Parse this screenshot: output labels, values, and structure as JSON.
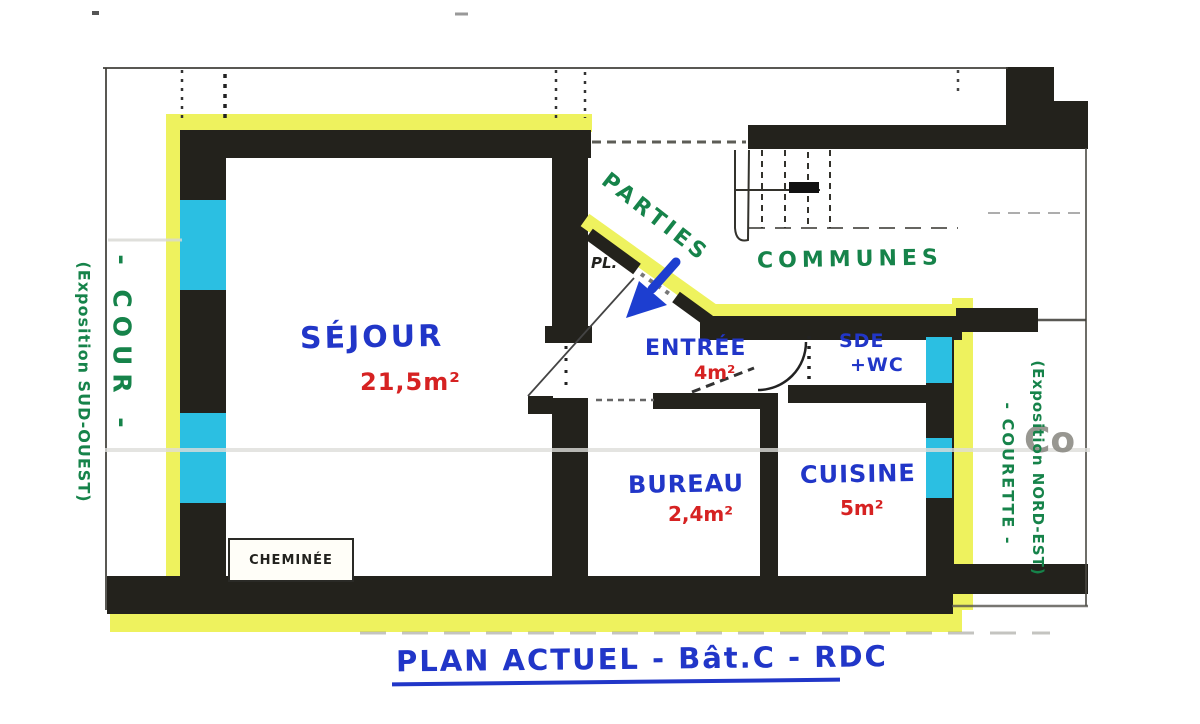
{
  "document": {
    "title": "PLAN ACTUEL - Bât.C - RDC"
  },
  "rooms": {
    "sejour": {
      "name": "SÉJOUR",
      "area": "21,5m²"
    },
    "entree": {
      "name": "ENTRÉE",
      "area": "4m²"
    },
    "bureau": {
      "name": "BUREAU",
      "area": "2,4m²"
    },
    "cuisine": {
      "name": "CUISINE",
      "area": "5m²"
    },
    "sde": {
      "name": "SDE",
      "name2": "+WC"
    }
  },
  "common_areas": {
    "word1": "PARTIES",
    "word2": "COMMUNES"
  },
  "annotations": {
    "closet": "PL.",
    "fireplace": "CHEMINÉE",
    "stamp": "Co",
    "left_exposure": "(Exposition SUD-OUEST)",
    "left_area": "- COUR -",
    "right_exposure": "(Exposition NORD-EST)",
    "right_area": "- COURETTE -"
  },
  "legend_colors": {
    "walls": "#23221c",
    "windows_highlight": "#2bbfe2",
    "unit_boundary_highlight": "#eef25e",
    "room_name_ink": "#2136c8",
    "area_ink": "#d62222",
    "exterior_note_ink": "#16834a"
  }
}
